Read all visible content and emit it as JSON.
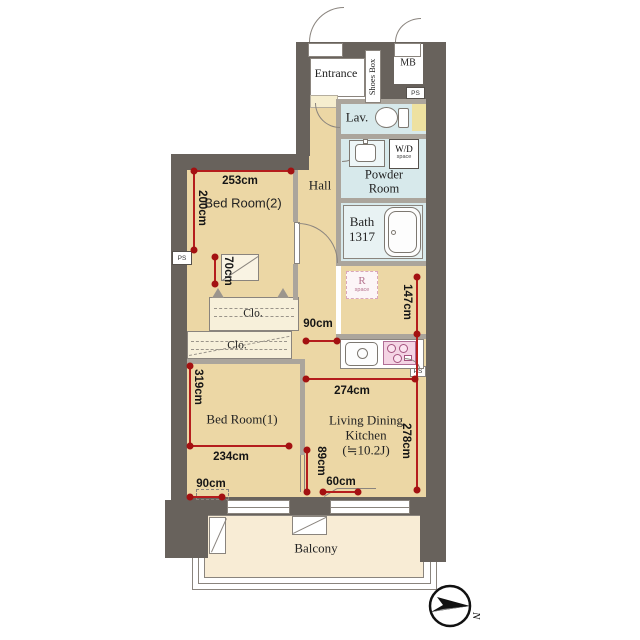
{
  "rooms": {
    "entrance": "Entrance",
    "shoes_box": "Shoes Box",
    "mb": "MB",
    "lav": "Lav.",
    "powder_room": "Powder Room",
    "wd": "W/D",
    "wd_space": "space",
    "bath_name": "Bath",
    "bath_size": "1317",
    "r": "R",
    "r_space": "space",
    "hall": "Hall",
    "bedroom2": "Bed Room(2)",
    "bedroom1": "Bed Room(1)",
    "closet_upper": "Clo.",
    "closet_lower": "Clo.",
    "ldk_line1": "Living Dining",
    "ldk_line2": "Kitchen",
    "ldk_line3": "(≒10.2J)",
    "balcony": "Balcony"
  },
  "labels": {
    "ps_entrance": "PS",
    "ps_left_wall": "PS",
    "ps_kitchen": "PS"
  },
  "measurements": {
    "bedroom2_width": "253cm",
    "bedroom2_depth": "200cm",
    "bedroom2_closet": "70cm",
    "hall_opening": "90cm",
    "bath_side": "147cm",
    "ldk_width": "274cm",
    "ldk_depth": "278cm",
    "ldk_west": "89cm",
    "ldk_bottom": "60cm",
    "bedroom1_depth": "319cm",
    "bedroom1_width": "234cm",
    "bedroom1_window": "90cm"
  },
  "compass": {
    "north_label": "N"
  },
  "colors": {
    "wall": "#68625c",
    "floor": "#ecd7a5",
    "wet_rooms": "#d7e9eb",
    "balcony": "#f8ecd5",
    "measure": "#b51d1d"
  }
}
